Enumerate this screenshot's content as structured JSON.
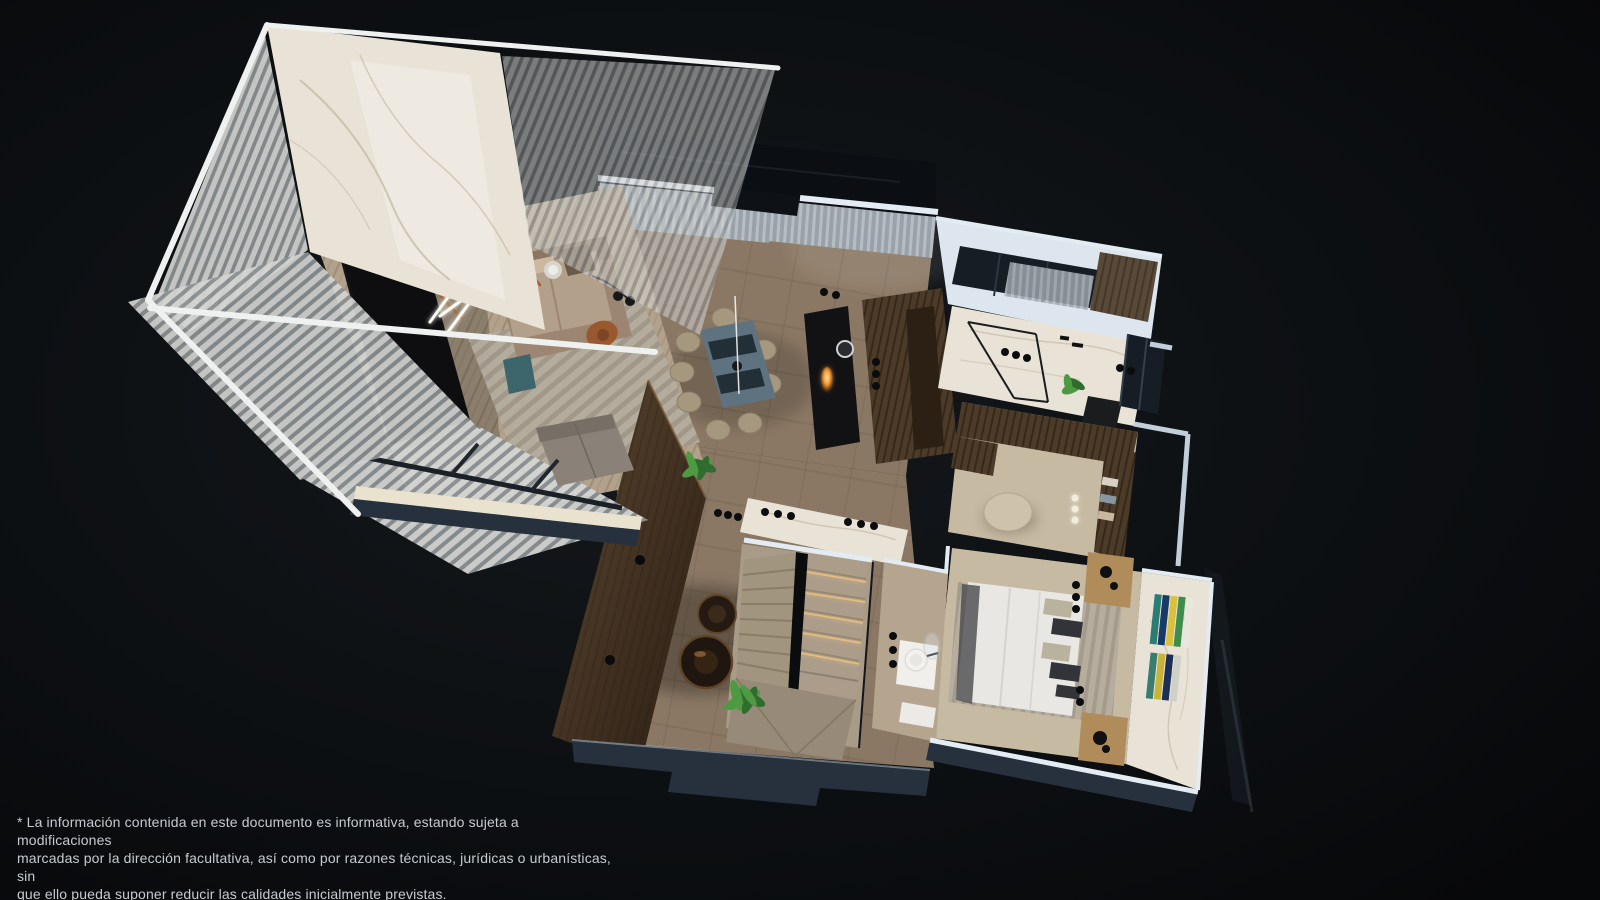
{
  "disclaimer": {
    "lines": [
      "* La información contenida en este documento es informativa, estando sujeta a modificaciones",
      "marcadas por la dirección facultativa, así como por razones técnicas, jurídicas o urbanísticas, sin",
      "que ello pueda suponer reducir las calidades inicialmente previstas."
    ],
    "full": "* La información contenida en este documento es informativa, estando sujeta a modificaciones marcadas por la dirección facultativa, así como por razones técnicas, jurídicas o urbanísticas, sin que ello pueda suponer reducir las calidades inicialmente previstas."
  },
  "palette": {
    "bg": "#0a0c0f",
    "bg_glow": "#16191d",
    "text": "#c6cbd1",
    "beam": "#eef1f0",
    "cap": "#e3ebf3",
    "cap_shade": "#c2cfda",
    "slab": "#27313d",
    "marble": "#e9e3d7",
    "marble_vein": "#b9ab92",
    "louver_light": "#d4d5d2",
    "louver_dark": "#8b9093",
    "plank1": "#b2a28c",
    "plank2": "#9f8e77",
    "tile": "#8b7864",
    "tile_line": "#6f5f4d",
    "stone": "#a89b88",
    "carpet": "#c7baa3",
    "rug1": "#b4ac9e",
    "rug2": "#a19889",
    "sofa": "#9c8672",
    "sofa_light": "#b3a08a",
    "rust": "#99582e",
    "teal": "#3c656c",
    "dining_table": "#5f7280",
    "runner": "#232f36",
    "chair": "#a6977f",
    "island": "#121215",
    "walnut": "#4d3b29",
    "walnut_dark": "#362818",
    "wardrobe": "#3a2c1f",
    "bed": "#e8e7e3",
    "pillow_dark": "#32343a",
    "pillow_plaid": "#b8b29f",
    "wood_light": "#b08c5a",
    "pouf": "#cfc2ac",
    "curtain1": "#99a2aa",
    "curtain2": "#b6bdc3",
    "glass": "#161d24",
    "copper": "#a05c32",
    "flame": "#f4a13a",
    "led_warm": "#eec27d",
    "plant_dark": "#2f6d2f",
    "plant_light": "#4e9a43",
    "basin": "#f2f1ed"
  }
}
